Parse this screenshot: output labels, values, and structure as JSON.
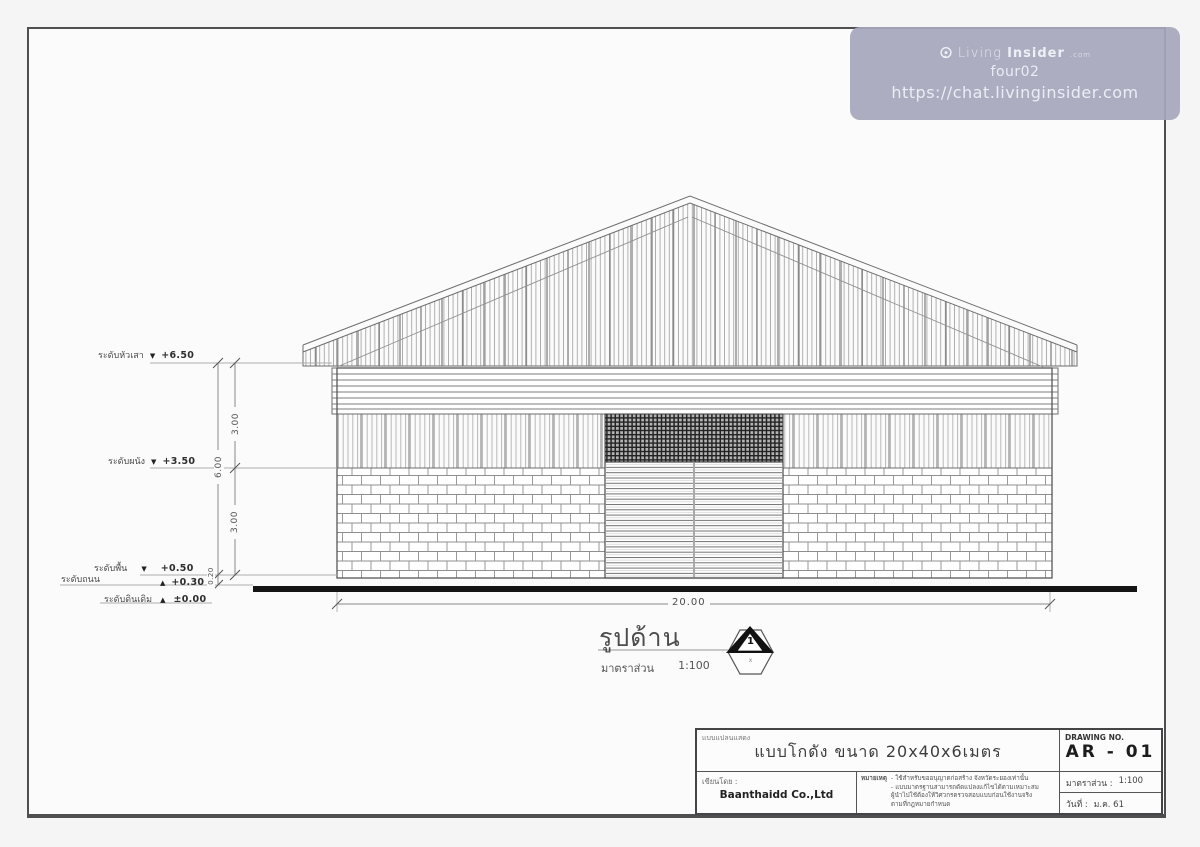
{
  "watermark": {
    "brand_prefix": "Living",
    "brand_bold": "Insider",
    "brand_tld": ".com",
    "username": "four02",
    "url": "https://chat.livinginsider.com"
  },
  "levels": [
    {
      "name": "ระดับหัวเสา",
      "marker": "▼",
      "value": "+6.50"
    },
    {
      "name": "ระดับผนัง",
      "marker": "▼",
      "value": "+3.50"
    },
    {
      "name": "ระดับพื้น",
      "marker": "▼",
      "value": "+0.50"
    },
    {
      "name": "ระดับถนน",
      "marker": "▲",
      "value": "+0.30"
    },
    {
      "name": "ระดับดินเดิม",
      "marker": "▲",
      "value": "±0.00"
    }
  ],
  "dimensions": {
    "upper": "3.00",
    "total": "6.00",
    "lower": "3.00",
    "plinth": "0.20",
    "width": "20.00"
  },
  "view": {
    "title": "รูปด้าน",
    "scale_label": "มาตราส่วน",
    "scale_value": "1:100",
    "marker_number": "1",
    "marker_ref": "x"
  },
  "title_block": {
    "form_label": "แบบแปลนแสดง",
    "project_title": "แบบโกดัง ขนาด 20x40x6เมตร",
    "drawing_no_label": "DRAWING NO.",
    "drawing_no": "AR - 01",
    "author_label": "เขียนโดย :",
    "author": "Baanthaidd Co.,Ltd",
    "notes_label": "หมายเหตุ",
    "notes": [
      "- ใช้สำหรับขออนุญาตก่อสร้าง จังหวัดระยองเท่านั้น",
      "- แบบมาตรฐานสามารถดัดแปลงแก้ไขได้ตามเหมาะสม",
      "ผู้นำไปใช้ต้องให้วิศวกรตรวจสอบแบบก่อนใช้งานจริง",
      "ตามที่กฎหมายกำหนด"
    ],
    "scale_label": "มาตราส่วน :",
    "scale_value": "1:100",
    "date_label": "วันที่ :",
    "date_value": "ม.ค. 61"
  },
  "colors": {
    "watermark_bg": "#a7a7bc",
    "ground_line": "#141414",
    "drawing_line": "#6e6e6e"
  }
}
